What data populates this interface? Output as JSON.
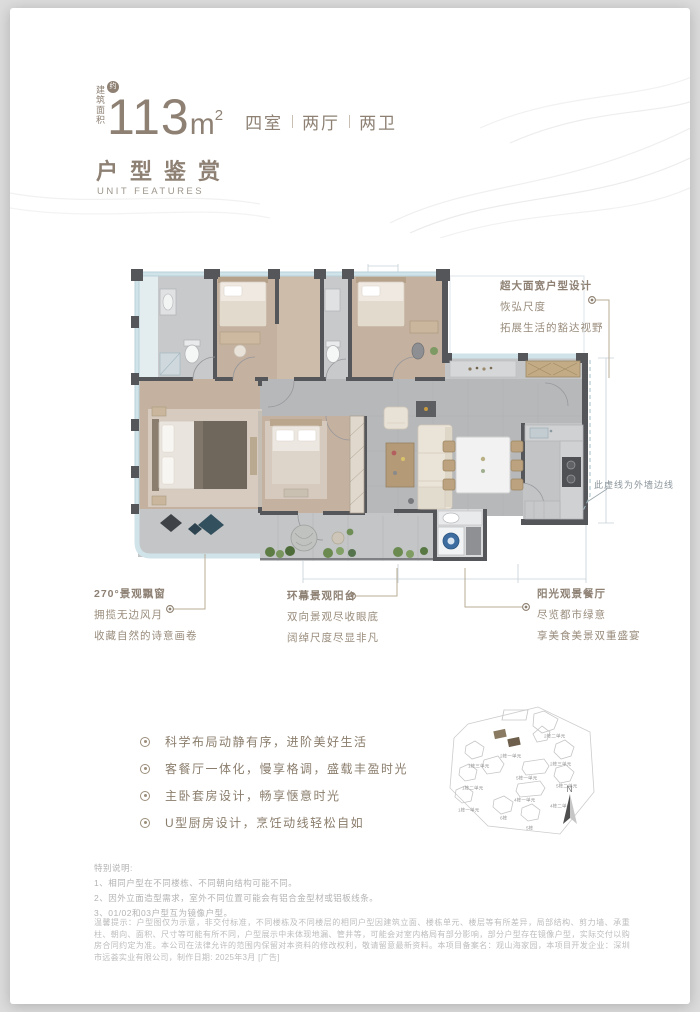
{
  "colors": {
    "brand_taupe": "#8e8174",
    "wall_gray": "#55565a",
    "wood_floor": "#c5b19f",
    "tile_floor": "#b7b8ba",
    "window_blue": "#cfe3e9",
    "plant_green": "#6a8a50",
    "highlight_building": "#8a7a62",
    "fineprint_gray": "#bdbdbd"
  },
  "header": {
    "area_label": "建筑面积",
    "approx_badge": "约",
    "area_value": "113",
    "area_unit": "m",
    "area_sup": "2",
    "rooms": [
      "四室",
      "两厅",
      "两卫"
    ]
  },
  "section": {
    "title_cn": "户型鉴赏",
    "title_en": "UNIT FEATURES"
  },
  "callouts": {
    "top_right": {
      "title": "超大面宽户型设计",
      "lines": [
        "恢弘尺度",
        "拓展生活的豁达视野"
      ]
    },
    "bay_window": {
      "title": "270°景观飘窗",
      "lines": [
        "拥揽无边风月",
        "收藏自然的诗意画卷"
      ]
    },
    "balcony": {
      "title": "环幕景观阳台",
      "lines": [
        "双向景观尽收眼底",
        "阔绰尺度尽显非凡"
      ]
    },
    "dining": {
      "title": "阳光观景餐厅",
      "lines": [
        "尽览都市绿意",
        "享美食美景双重盛宴"
      ]
    },
    "wall_note": "此虚线为外墙边线"
  },
  "features": [
    "科学布局动静有序，进阶美好生活",
    "客餐厅一体化，慢享格调，盛载丰盈时光",
    "主卧套房设计，畅享惬意时光",
    "U型厨房设计，烹饪动线轻松自如"
  ],
  "siteplan": {
    "labels": [
      {
        "text": "2栋二单元"
      },
      {
        "text": "2栋一单元"
      },
      {
        "text": "2栋三单元"
      },
      {
        "text": "1栋三单元"
      },
      {
        "text": "5栋一单元"
      },
      {
        "text": "5栋二单元"
      },
      {
        "text": "1栋二单元"
      },
      {
        "text": "4栋一单元"
      },
      {
        "text": "4栋二单元"
      },
      {
        "text": "1栋一单元"
      },
      {
        "text": "6栋"
      },
      {
        "text": "5栋"
      }
    ],
    "compass": "N"
  },
  "notes": {
    "title": "特别说明:",
    "items": [
      "1、相同户型在不同楼栋、不同朝向结构可能不同。",
      "2、因外立面造型需求，室外不同位置可能会有铝合金型材或铝板线条。",
      "3、01/02和03户型互为镜像户型。"
    ]
  },
  "disclaimer": "温馨提示：户型图仅为示意，非交付标准，不同楼栋及不同楼层的相同户型因建筑立面、楼栋单元、楼层等有所差异，局部结构、剪力墙、承重柱、朝向、面积、尺寸等可能有所不同，户型展示中未体现地漏、管井等，可能会对室内格局有部分影响，部分户型存在镜像户型，实际交付以购房合同约定为准。本公司在法律允许的范围内保留对本资料的修改权利，敬请留意最新资料。本项目备案名：观山海家园，本项目开发企业：深圳市远荟实业有限公司，制作日期: 2025年3月 [广告]"
}
